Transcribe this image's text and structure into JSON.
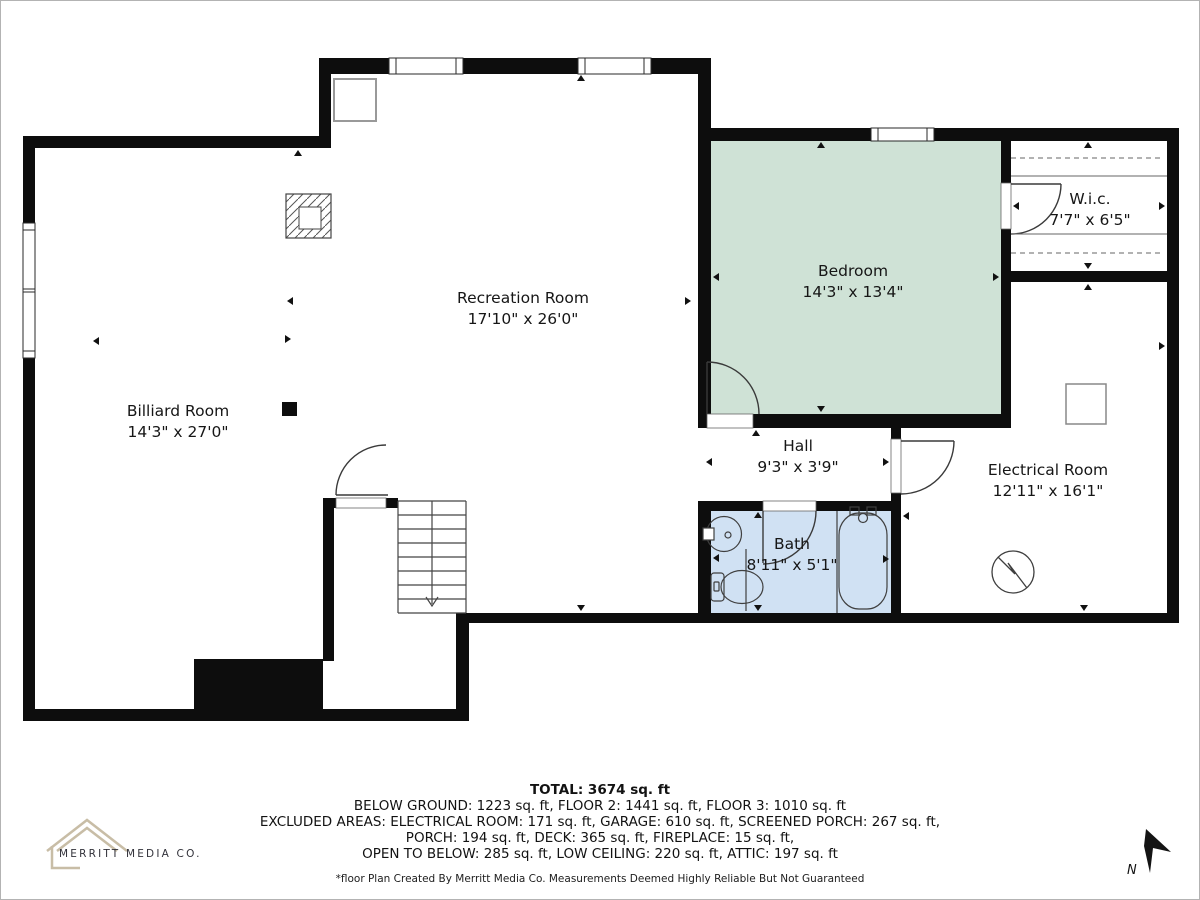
{
  "rooms": {
    "recreation": {
      "name": "Recreation Room",
      "dims": "17'10\" x 26'0\""
    },
    "billiard": {
      "name": "Billiard Room",
      "dims": "14'3\" x 27'0\""
    },
    "bedroom": {
      "name": "Bedroom",
      "dims": "14'3\" x 13'4\""
    },
    "wic": {
      "name": "W.i.c.",
      "dims": "7'7\" x 6'5\""
    },
    "hall": {
      "name": "Hall",
      "dims": "9'3\" x 3'9\""
    },
    "electrical": {
      "name": "Electrical Room",
      "dims": "12'11\" x 16'1\""
    },
    "bath": {
      "name": "Bath",
      "dims": "8'11\" x 5'1\""
    }
  },
  "footer": {
    "total": "TOTAL: 3674 sq. ft",
    "line1": "BELOW GROUND: 1223 sq. ft, FLOOR 2: 1441 sq. ft, FLOOR 3: 1010 sq. ft",
    "line2": "EXCLUDED AREAS: ELECTRICAL ROOM: 171 sq. ft, GARAGE: 610 sq. ft, SCREENED PORCH: 267 sq. ft,",
    "line3": "PORCH: 194 sq. ft, DECK: 365 sq. ft, FIREPLACE: 15 sq. ft,",
    "line4": "OPEN TO BELOW: 285 sq. ft, LOW CEILING: 220 sq. ft, ATTIC: 197 sq. ft",
    "disclaimer": "*floor Plan Created By Merritt Media Co. Measurements Deemed Highly Reliable But Not Guaranteed"
  },
  "branding": {
    "company": "MERRITT MEDIA CO."
  },
  "compass": {
    "label": "N"
  },
  "colors": {
    "bedroom_fill": "#cfe2d6",
    "bath_fill": "#d0e1f3",
    "wall": "#0d0d0d",
    "accent_tan": "#c8bda6"
  }
}
